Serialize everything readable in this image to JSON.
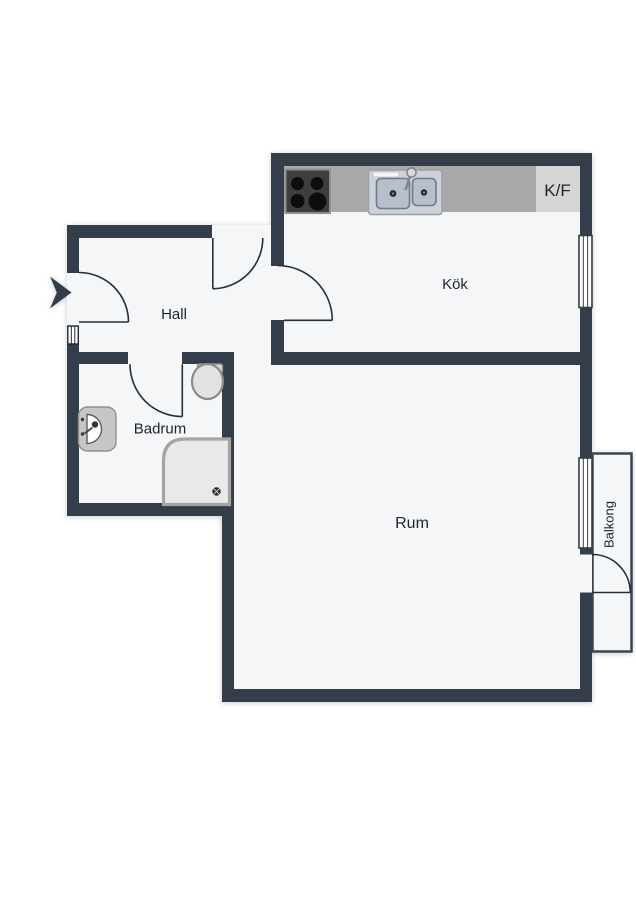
{
  "rooms": {
    "hall": {
      "label": "Hall"
    },
    "kok": {
      "label": "Kök"
    },
    "badrum": {
      "label": "Badrum"
    },
    "rum": {
      "label": "Rum"
    },
    "balkong": {
      "label": "Balkong"
    }
  },
  "kitchen": {
    "fridge_freezer_label": "K/F"
  },
  "fixture_icons": {
    "stove": "stove-4-burner-icon",
    "sink": "double-basin-sink-icon",
    "faucet": "faucet-icon",
    "toilet": "toilet-icon",
    "washbasin": "washbasin-icon",
    "shower": "shower-with-drain-icon",
    "entry": "entry-arrow-icon",
    "window": "window-symbol",
    "threshold": "door-threshold-symbol"
  },
  "colors": {
    "wall": "#333e4a",
    "floor": "#f4f6f8",
    "counter": "#a9a9a9",
    "kf_box": "#d5d5d3",
    "stove_top": "#3e3e3e",
    "burner": "#0d0d0d",
    "sink_panel": "#cdd2d9",
    "sink_basin": "#b7bfcb",
    "fixture_gray": "#c6c6c6",
    "shower_fill": "#e9e9e9",
    "door_line": "#272e36",
    "label_text": "#1f242a"
  }
}
